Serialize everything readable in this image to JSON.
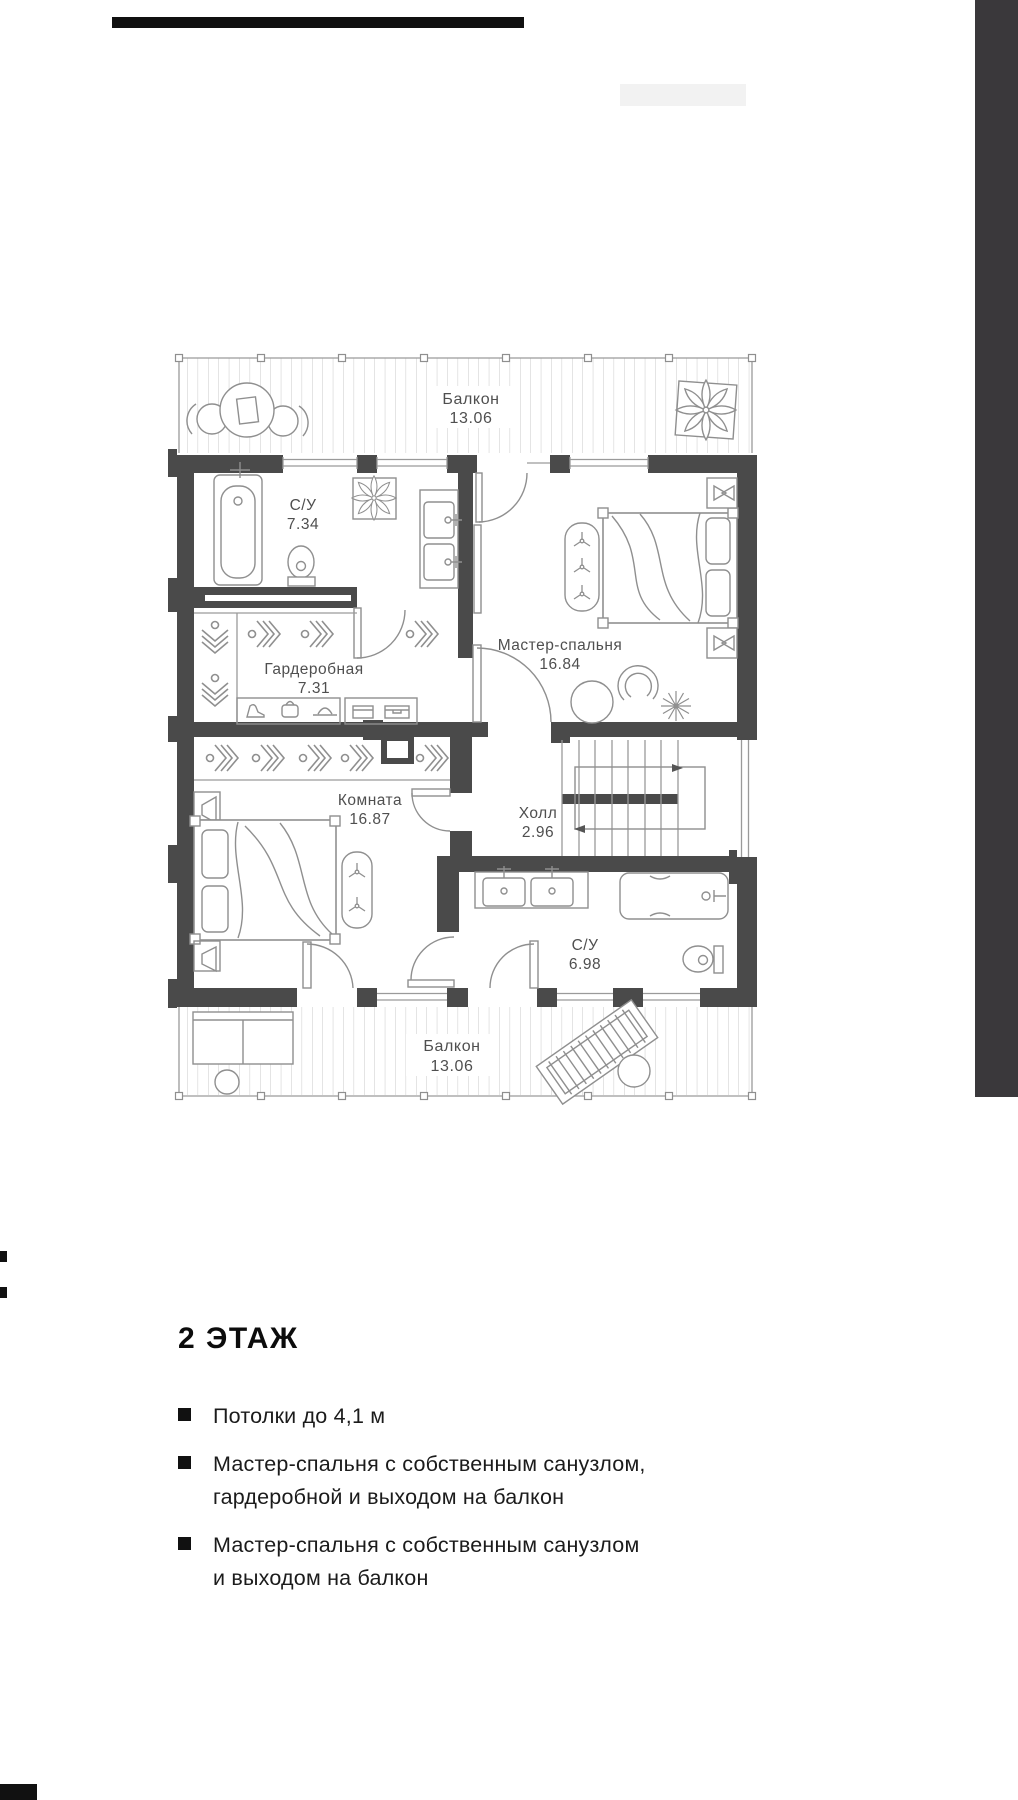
{
  "plan": {
    "balcony_top": {
      "name": "Балкон",
      "area": "13.06"
    },
    "bath_top": {
      "name": "С/У",
      "area": "7.34"
    },
    "master": {
      "name": "Мастер-спальня",
      "area": "16.84"
    },
    "wardrobe": {
      "name": "Гардеробная",
      "area": "7.31"
    },
    "room": {
      "name": "Комната",
      "area": "16.87"
    },
    "hall": {
      "name": "Холл",
      "area": "2.96"
    },
    "bath_bottom": {
      "name": "С/У",
      "area": "6.98"
    },
    "balcony_bottom": {
      "name": "Балкон",
      "area": "13.06"
    }
  },
  "info": {
    "title": "2 ЭТАЖ",
    "bullets": [
      {
        "line1": "Потолки до 4,1 м",
        "line2": ""
      },
      {
        "line1": "Мастер-спальня с собственным санузлом,",
        "line2": "гардеробной и выходом на балкон"
      },
      {
        "line1": "Мастер-спальня с собственным санузлом",
        "line2": "и выходом на балкон"
      }
    ]
  },
  "colors": {
    "wall": "#4a4a4a",
    "sidebar": "#3a383b",
    "label": "#4f4f4f"
  }
}
